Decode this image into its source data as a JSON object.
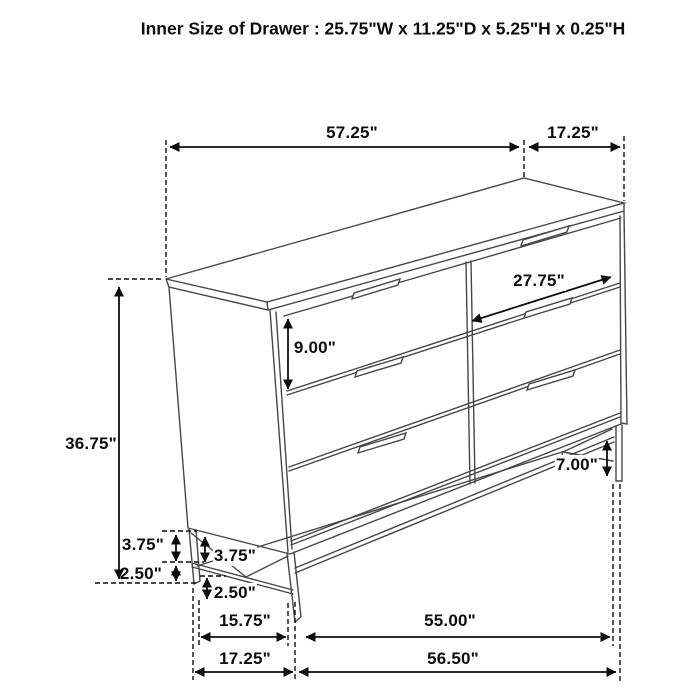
{
  "title": "Inner Size of Drawer : 25.75\"W x 11.25\"D x 5.25\"H x 0.25\"H",
  "figure": "six-drawer-dresser-dimension-diagram",
  "dimensions": {
    "top_width": "57.25\"",
    "top_depth": "17.25\"",
    "drawer_front_width": "27.75\"",
    "drawer_front_height": "9.00\"",
    "overall_height": "36.75\"",
    "base_gap_outer": "3.75\"",
    "base_gap_inner": "3.75\"",
    "stretcher_height_outer": "2.50\"",
    "stretcher_height_inner": "2.50\"",
    "leg_height": "7.00\"",
    "bottom_inner_depth": "15.75\"",
    "bottom_depth": "17.25\"",
    "base_width": "55.00\"",
    "bottom_width": "56.50\""
  },
  "colors": {
    "background": "#ffffff",
    "furniture_line": "#474747",
    "dimension_line": "#0d0d0d",
    "text": "#0d0d0d"
  }
}
